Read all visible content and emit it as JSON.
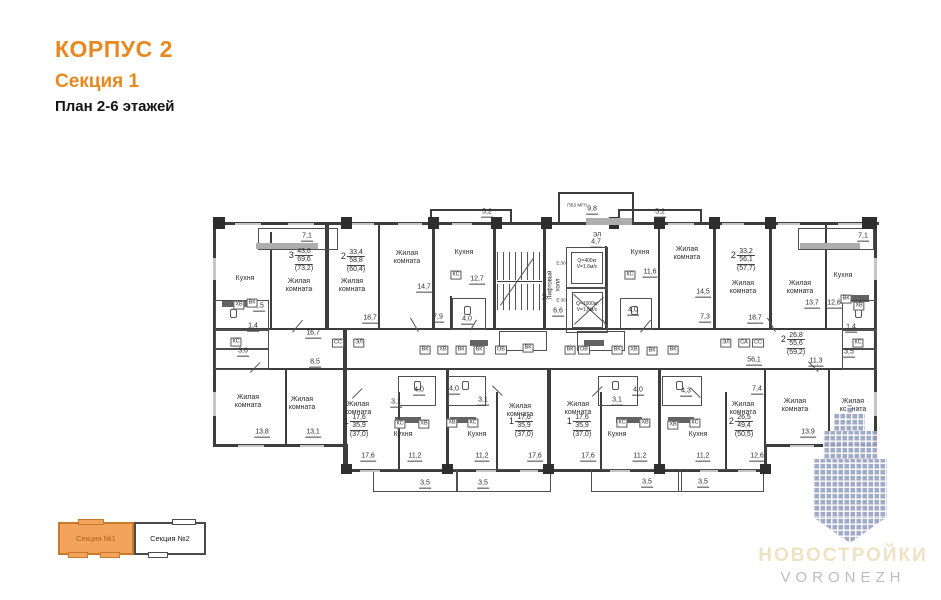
{
  "header": {
    "title": "КОРПУС 2",
    "subtitle": "Секция 1",
    "plan_level": "План 2-6 этажей"
  },
  "legend": {
    "sections": [
      {
        "label": "Секция №1",
        "active": true
      },
      {
        "label": "Секция №2",
        "active": false
      }
    ]
  },
  "logo": {
    "title": "НОВОСТРОЙКИ",
    "subtitle": "VORONEZH"
  },
  "colors": {
    "accent": "#E8881E",
    "legend_active_fill": "#F2A45C",
    "legend_active_border": "#C9792B",
    "wall": "#3d3d3d",
    "watermark": "#9BA4C2",
    "logo_title": "#EFE2C4",
    "logo_subtitle": "#BDBDBD"
  },
  "plan": {
    "apartments": [
      {
        "n": "3",
        "a": "43,6",
        "b": "69,6",
        "c": "(73,2)",
        "x": 301,
        "y": 248
      },
      {
        "n": "2",
        "a": "33,4",
        "b": "58,8",
        "c": "(60,4)",
        "x": 353,
        "y": 249
      },
      {
        "n": "2",
        "a": "33,2",
        "b": "56,1",
        "c": "(57,7)",
        "x": 743,
        "y": 248
      },
      {
        "n": "2",
        "a": "26,8",
        "b": "55,6",
        "c": "(59,2)",
        "x": 793,
        "y": 332
      },
      {
        "n": "1",
        "a": "17,6",
        "b": "35,9",
        "c": "(37,0)",
        "x": 356,
        "y": 414
      },
      {
        "n": "1",
        "a": "17,6",
        "b": "35,9",
        "c": "(37,0)",
        "x": 521,
        "y": 414
      },
      {
        "n": "1",
        "a": "17,6",
        "b": "35,9",
        "c": "(37,0)",
        "x": 579,
        "y": 414
      },
      {
        "n": "2",
        "a": "26,5",
        "b": "49,4",
        "c": "(50,5)",
        "x": 741,
        "y": 414
      }
    ],
    "room_labels": [
      {
        "t": "Кухня",
        "x": 245,
        "y": 279
      },
      {
        "t": "Жилая\nкомната",
        "x": 299,
        "y": 286
      },
      {
        "t": "Жилая\nкомната",
        "x": 352,
        "y": 286
      },
      {
        "t": "Жилая\nкомната",
        "x": 407,
        "y": 258
      },
      {
        "t": "Кухня",
        "x": 464,
        "y": 253
      },
      {
        "t": "Кухня",
        "x": 640,
        "y": 253
      },
      {
        "t": "Жилая\nкомната",
        "x": 687,
        "y": 254
      },
      {
        "t": "Жилая\nкомната",
        "x": 743,
        "y": 288
      },
      {
        "t": "Жилая\nкомната",
        "x": 800,
        "y": 288
      },
      {
        "t": "Кухня",
        "x": 843,
        "y": 276
      },
      {
        "t": "Жилая\nкомната",
        "x": 248,
        "y": 402
      },
      {
        "t": "Жилая\nкомната",
        "x": 302,
        "y": 404
      },
      {
        "t": "Жилая\nкомната",
        "x": 358,
        "y": 409
      },
      {
        "t": "Кухня",
        "x": 403,
        "y": 435
      },
      {
        "t": "Кухня",
        "x": 477,
        "y": 435
      },
      {
        "t": "Жилая\nкомната",
        "x": 520,
        "y": 411
      },
      {
        "t": "Жилая\nкомната",
        "x": 578,
        "y": 409
      },
      {
        "t": "Кухня",
        "x": 617,
        "y": 435
      },
      {
        "t": "Кухня",
        "x": 698,
        "y": 435
      },
      {
        "t": "Жилая\nкомната",
        "x": 743,
        "y": 409
      },
      {
        "t": "Жилая\nкомната",
        "x": 795,
        "y": 406
      },
      {
        "t": "Жилая\nкомната",
        "x": 853,
        "y": 406
      }
    ],
    "area_labels": [
      {
        "v": "7,1",
        "x": 307,
        "y": 237
      },
      {
        "v": "5,2",
        "x": 487,
        "y": 213
      },
      {
        "v": "9,8",
        "x": 592,
        "y": 210
      },
      {
        "v": "5,2",
        "x": 660,
        "y": 213
      },
      {
        "v": "7,1",
        "x": 863,
        "y": 237
      },
      {
        "v": "4,7",
        "x": 596,
        "y": 243
      },
      {
        "v": "14,7",
        "x": 424,
        "y": 288
      },
      {
        "v": "12,7",
        "x": 477,
        "y": 280
      },
      {
        "v": "11,6",
        "x": 650,
        "y": 273
      },
      {
        "v": "14,5",
        "x": 703,
        "y": 293
      },
      {
        "v": "2,5",
        "x": 259,
        "y": 307
      },
      {
        "v": "1,4",
        "x": 253,
        "y": 327
      },
      {
        "v": "3,6",
        "x": 243,
        "y": 352
      },
      {
        "v": "16,7",
        "x": 313,
        "y": 334
      },
      {
        "v": "8,5",
        "x": 315,
        "y": 363
      },
      {
        "v": "7,9",
        "x": 438,
        "y": 318
      },
      {
        "v": "4,0",
        "x": 467,
        "y": 320
      },
      {
        "v": "18,7",
        "x": 370,
        "y": 319
      },
      {
        "v": "4,0",
        "x": 633,
        "y": 311
      },
      {
        "v": "7,3",
        "x": 705,
        "y": 318
      },
      {
        "v": "18,7",
        "x": 755,
        "y": 319
      },
      {
        "v": "13,7",
        "x": 812,
        "y": 304
      },
      {
        "v": "12,6",
        "x": 834,
        "y": 304
      },
      {
        "v": "6,6",
        "x": 558,
        "y": 312
      },
      {
        "v": "56,1",
        "x": 754,
        "y": 361
      },
      {
        "v": "11,3",
        "x": 816,
        "y": 362
      },
      {
        "v": "1,4",
        "x": 851,
        "y": 328
      },
      {
        "v": "3,5",
        "x": 849,
        "y": 353
      },
      {
        "v": "13,8",
        "x": 262,
        "y": 433
      },
      {
        "v": "13,1",
        "x": 313,
        "y": 433
      },
      {
        "v": "17,6",
        "x": 368,
        "y": 457
      },
      {
        "v": "11,2",
        "x": 415,
        "y": 457
      },
      {
        "v": "11,2",
        "x": 482,
        "y": 457
      },
      {
        "v": "17,6",
        "x": 535,
        "y": 457
      },
      {
        "v": "17,6",
        "x": 588,
        "y": 457
      },
      {
        "v": "11,2",
        "x": 640,
        "y": 457
      },
      {
        "v": "11,2",
        "x": 703,
        "y": 457
      },
      {
        "v": "12,6",
        "x": 757,
        "y": 457
      },
      {
        "v": "13,9",
        "x": 808,
        "y": 433
      },
      {
        "v": "4,0",
        "x": 419,
        "y": 391
      },
      {
        "v": "3,1",
        "x": 396,
        "y": 403
      },
      {
        "v": "4,0",
        "x": 454,
        "y": 390
      },
      {
        "v": "3,1",
        "x": 483,
        "y": 401
      },
      {
        "v": "3,1",
        "x": 617,
        "y": 401
      },
      {
        "v": "4,0",
        "x": 638,
        "y": 391
      },
      {
        "v": "4,3",
        "x": 686,
        "y": 392
      },
      {
        "v": "7,4",
        "x": 757,
        "y": 390
      },
      {
        "v": "3,5",
        "x": 425,
        "y": 484
      },
      {
        "v": "3,5",
        "x": 483,
        "y": 484
      },
      {
        "v": "3,5",
        "x": 647,
        "y": 483
      },
      {
        "v": "3,5",
        "x": 703,
        "y": 483
      }
    ],
    "tag_labels": [
      {
        "v": "ХВ",
        "x": 239,
        "y": 305
      },
      {
        "v": "ВК",
        "x": 252,
        "y": 303
      },
      {
        "v": "КС",
        "x": 236,
        "y": 342
      },
      {
        "v": "КС",
        "x": 456,
        "y": 275
      },
      {
        "v": "КС",
        "x": 630,
        "y": 275
      },
      {
        "v": "ВК",
        "x": 846,
        "y": 299
      },
      {
        "v": "ХВ",
        "x": 859,
        "y": 306
      },
      {
        "v": "КС",
        "x": 858,
        "y": 343
      },
      {
        "v": "СС",
        "x": 338,
        "y": 343
      },
      {
        "v": "ЭЛ",
        "x": 359,
        "y": 343
      },
      {
        "v": "ЭЛ",
        "x": 726,
        "y": 343
      },
      {
        "v": "СА",
        "x": 744,
        "y": 343
      },
      {
        "v": "СС",
        "x": 758,
        "y": 343
      },
      {
        "v": "ВК",
        "x": 425,
        "y": 350
      },
      {
        "v": "ХВ",
        "x": 443,
        "y": 350
      },
      {
        "v": "ВК",
        "x": 461,
        "y": 350
      },
      {
        "v": "ВК",
        "x": 479,
        "y": 350
      },
      {
        "v": "ОВ",
        "x": 501,
        "y": 350
      },
      {
        "v": "ВК",
        "x": 528,
        "y": 348
      },
      {
        "v": "ВК",
        "x": 570,
        "y": 350
      },
      {
        "v": "ОВ",
        "x": 584,
        "y": 350
      },
      {
        "v": "ВК",
        "x": 617,
        "y": 350
      },
      {
        "v": "ХВ",
        "x": 634,
        "y": 350
      },
      {
        "v": "ВК",
        "x": 652,
        "y": 351
      },
      {
        "v": "ВК",
        "x": 673,
        "y": 350
      },
      {
        "v": "КС",
        "x": 400,
        "y": 424
      },
      {
        "v": "ХВ",
        "x": 424,
        "y": 424
      },
      {
        "v": "ХВ",
        "x": 452,
        "y": 423
      },
      {
        "v": "КС",
        "x": 473,
        "y": 423
      },
      {
        "v": "КС",
        "x": 622,
        "y": 423
      },
      {
        "v": "ХВ",
        "x": 645,
        "y": 423
      },
      {
        "v": "ХВ",
        "x": 673,
        "y": 425
      },
      {
        "v": "КС",
        "x": 695,
        "y": 423
      }
    ],
    "notes": [
      {
        "v": "ПБЗ МГН",
        "x": 577,
        "y": 205,
        "fs": 4.5
      },
      {
        "v": "ЭЛ",
        "x": 597,
        "y": 236,
        "fs": 6
      },
      {
        "v": "Е:30",
        "x": 561,
        "y": 263,
        "fs": 4.5
      },
      {
        "v": "Е:30",
        "x": 561,
        "y": 300,
        "fs": 4.5
      },
      {
        "v": "Q=400кг\nV=1,6м/с",
        "x": 587,
        "y": 264,
        "fs": 5
      },
      {
        "v": "Q=1000кг\nV=1,6м/с",
        "x": 587,
        "y": 307,
        "fs": 5
      }
    ],
    "vertical_labels": [
      {
        "v": "Лифтовый\nхолл",
        "x": 555,
        "y": 285,
        "fs": 6
      },
      {
        "v": "ЭЛ",
        "x": 546,
        "y": 297,
        "fs": 5.5
      }
    ]
  }
}
